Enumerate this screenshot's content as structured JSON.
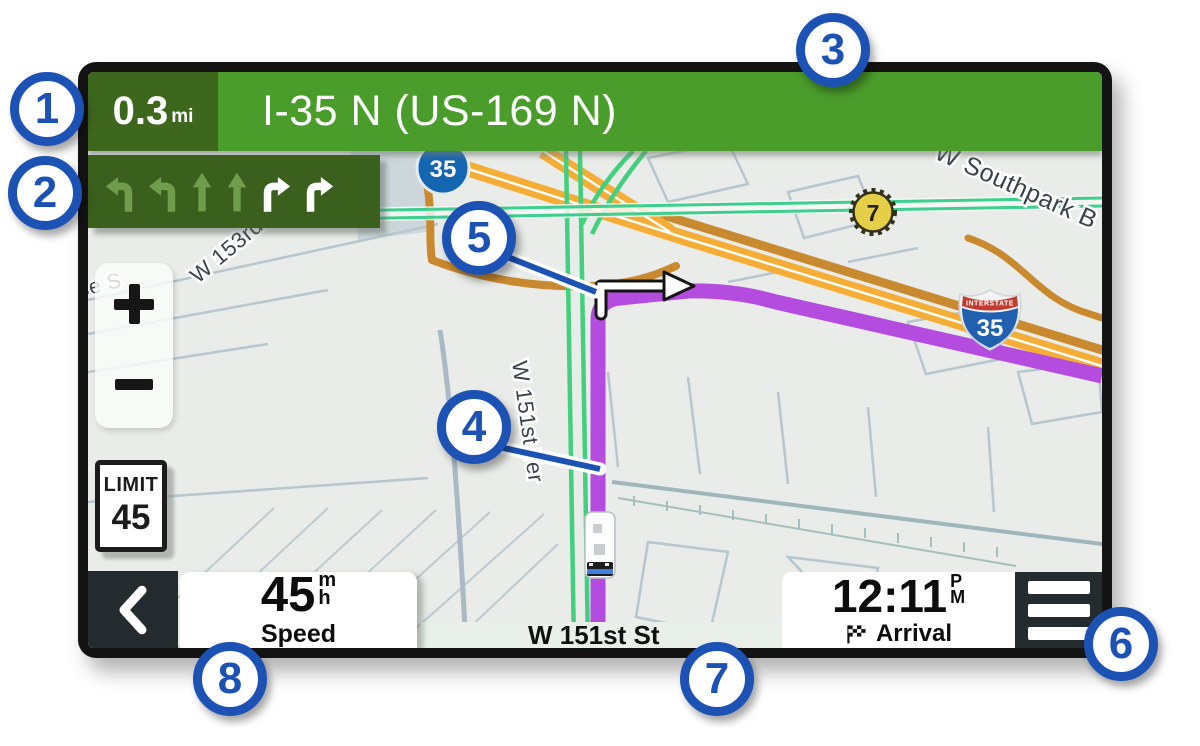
{
  "navigation": {
    "distance_value": "0.3",
    "distance_unit": "mi",
    "instruction": "I-35 N (US-169 N)",
    "lane_guidance": [
      "turn-left-dim",
      "turn-left-dim",
      "straight-dim",
      "straight-dim",
      "turn-right-active",
      "turn-right-active"
    ]
  },
  "map": {
    "labels": {
      "southpark": "W Southpark B",
      "w153rd": "W 153rd",
      "w151st_ter": "W 151st Ter",
      "ce_st": "ce S"
    },
    "shields": {
      "highway_circle": "35",
      "route_badge": "7",
      "interstate_header": "INTERSTATE",
      "interstate_number": "35"
    },
    "speed_limit": {
      "label": "LIMIT",
      "value": "45"
    },
    "zoom_controls": [
      "zoom-in-icon",
      "zoom-out-icon"
    ]
  },
  "status_bar": {
    "speed": {
      "value": "45",
      "unit_top": "m",
      "unit_bottom": "h",
      "label": "Speed"
    },
    "street_name": "W 151st St",
    "arrival": {
      "time": "12:11",
      "meridiem_top": "P",
      "meridiem_bottom": "M",
      "label": "Arrival"
    }
  },
  "callouts": [
    {
      "number": "1"
    },
    {
      "number": "2"
    },
    {
      "number": "3"
    },
    {
      "number": "4"
    },
    {
      "number": "5"
    },
    {
      "number": "6"
    },
    {
      "number": "7"
    },
    {
      "number": "8"
    }
  ],
  "colors": {
    "callout_blue": "#1c52b4",
    "instruction_green": "#4a9c2b",
    "panel_dark_green": "#3b5f1d",
    "route_purple": "#b44ce0",
    "highway_orange": "#f5ad36",
    "traffic_green": "#3ccf8e"
  }
}
